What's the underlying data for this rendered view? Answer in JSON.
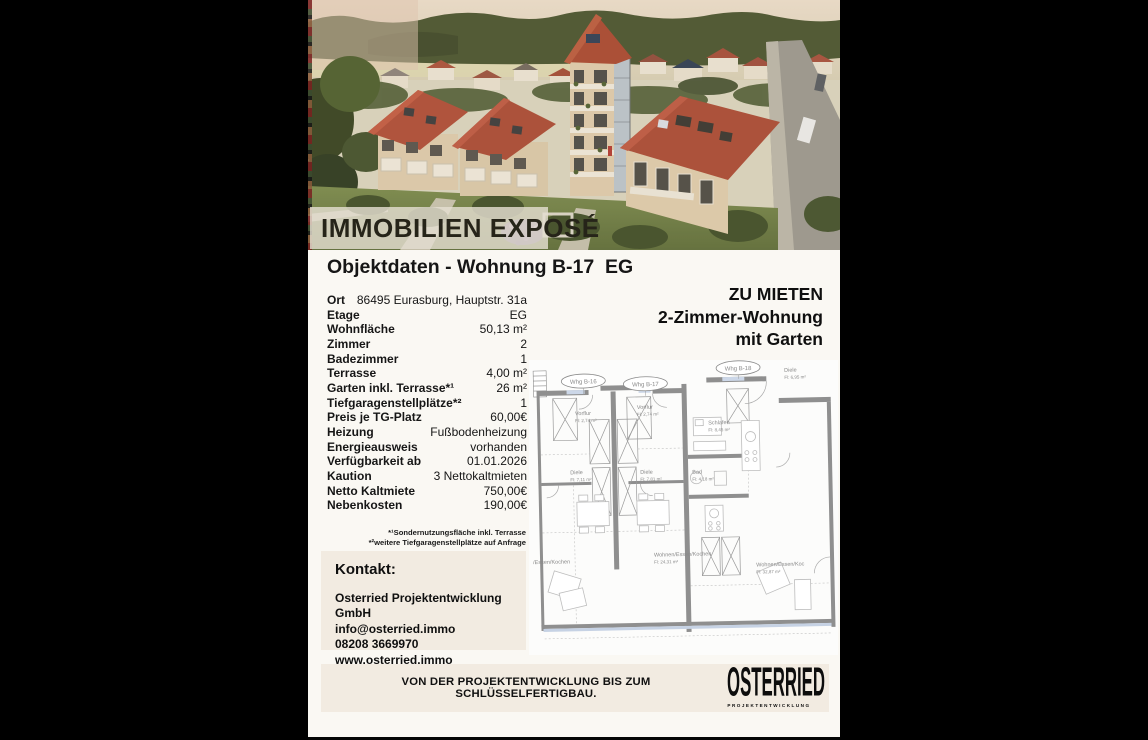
{
  "banner_title": "IMMOBILIEN EXPOSÉ",
  "heading": "Objektdaten - Wohnung B-17  EG",
  "offer": {
    "line1": "ZU MIETEN",
    "line2": "2-Zimmer-Wohnung",
    "line3": "mit Garten"
  },
  "table": {
    "rows": [
      {
        "label": "Ort",
        "value": "86495 Eurasburg, Hauptstr. 31a"
      },
      {
        "label": "Etage",
        "value": "EG"
      },
      {
        "label": "Wohnfläche",
        "value": "50,13 m²"
      },
      {
        "label": "Zimmer",
        "value": "2"
      },
      {
        "label": "Badezimmer",
        "value": "1"
      },
      {
        "label": "Terrasse",
        "value": "4,00 m²"
      },
      {
        "label": "Garten inkl. Terrasse*¹",
        "value": "26 m²"
      },
      {
        "label": "Tiefgaragenstellplätze*²",
        "value": "1"
      },
      {
        "label": "Preis je TG-Platz",
        "value": "60,00€"
      },
      {
        "label": "Heizung",
        "value": "Fußbodenheizung"
      },
      {
        "label": "Energieausweis",
        "value": "vorhanden"
      },
      {
        "label": "Verfügbarkeit ab",
        "value": "01.01.2026"
      },
      {
        "label": "Kaution",
        "value": "3 Nettokaltmieten"
      },
      {
        "label": "Netto Kaltmiete",
        "value": "750,00€"
      },
      {
        "label": "Nebenkosten",
        "value": "190,00€"
      }
    ]
  },
  "footnotes": [
    "*¹Sondernutzungsfläche inkl. Terrasse",
    "*²weitere Tiefgaragenstellplätze auf Anfrage"
  ],
  "contact": {
    "heading": "Kontakt:",
    "lines": [
      "Osterried Projektentwicklung GmbH",
      "info@osterried.immo",
      "08208 3669970",
      "www.osterried.immo"
    ]
  },
  "footer": {
    "slogan": "VON DER PROJEKTENTWICKLUNG BIS ZUM SCHLÜSSELFERTIGBAU.",
    "logo_main": "OSTERRIED",
    "logo_sub": "PROJEKTENTWICKLUNG"
  },
  "floorplan": {
    "units": {
      "b16": "Whg B-16",
      "b17": "Whg B-17",
      "b18": "Whg B-18"
    },
    "rooms": {
      "diele_b18": {
        "name": "Diele",
        "area": "Fl: 6,95 m²"
      },
      "vorflur_b16": {
        "name": "Vorflur",
        "area": "Fl: 2,74 m²"
      },
      "vorflur_b17": {
        "name": "Vorflur",
        "area": "Fl: 2,74 m²"
      },
      "diele_b16": {
        "name": "Diele",
        "area": "Fl: 7,11 m²"
      },
      "diele_b17": {
        "name": "Diele",
        "area": "Fl: 7,81 m²"
      },
      "schlafen": {
        "name": "Schlafen",
        "area": "Fl: 8,45 m²"
      },
      "bad": {
        "name": "Bad",
        "area": "Fl: 4,18 m²"
      },
      "wohnen_left": {
        "name": "/Essen/Kochen",
        "area": ""
      },
      "wohnen_mid": {
        "name": "Wohnen/Essen/Kochen",
        "area": "Fl: 24,31 m²"
      },
      "wohnen_right": {
        "name": "Wohnen/Essen/Koc",
        "area": "Fl: 32,87 m²"
      }
    }
  },
  "colors": {
    "page_background": "#faf8f3",
    "box_beige": "#f2ebe1",
    "roof_red": "#a84a33",
    "facade_beige": "#dbc9a9",
    "text_dark": "#161616"
  }
}
